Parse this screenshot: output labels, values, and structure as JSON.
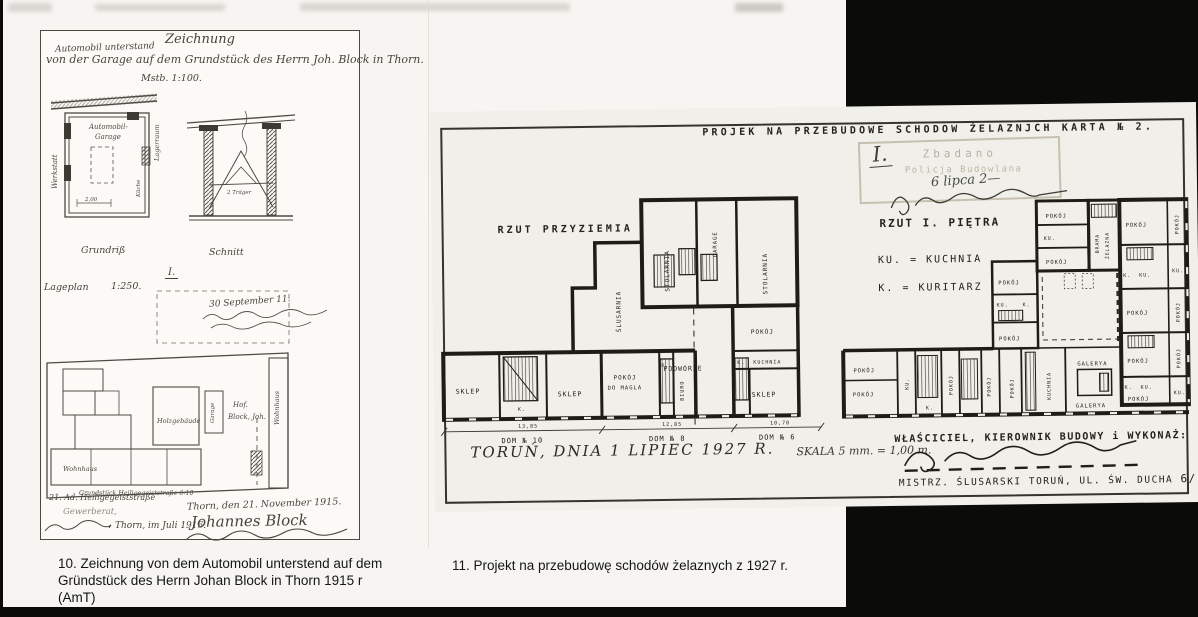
{
  "captions": {
    "c10_l1": "10. Zeichnung von dem Automobil unterstend auf dem",
    "c10_l2": "Gründstück des Herrn Johan Block in Thorn 1915 r (AmT)",
    "c11": "11. Projekt na przebudowę schodów żelaznych z 1927 r."
  },
  "doc10": {
    "title": "Zeichnung",
    "note_small": "Automobil unterstand",
    "subtitle": "von der Garage auf dem Grundstück des Herrn Joh. Block in Thorn.",
    "scale": "Mstb. 1:100.",
    "grundriss": "Grundriß",
    "schnitt": "Schnitt",
    "roman": "I.",
    "lageplan": "Lageplan",
    "lageplan_scale": "1:250.",
    "note_hand": "30 September 11.",
    "werkstatt": "Werkstatt",
    "garage_l1": "Automobil-",
    "garage_l2": "Garage",
    "kueche": "Küche",
    "lagerraum": "Lagerraum",
    "dim_200": "2,00",
    "traeger": "2 Träger",
    "holzgebaeude": "Holzgebäude",
    "garage_site": "Garage",
    "hof_l1": "Hof.",
    "hof_l2": "Block, Joh.",
    "wohnhaus": "Wohnhaus",
    "grundstueck": "Grundstück Heiligegeiststraße 6-10",
    "addr_note": "21. Ad. Heiligegeiststraße",
    "gewerberat": "Gewerberat,",
    "date_left": "Thorn, im Juli 1916.",
    "date_right": "Thorn, den 21. November 1915.",
    "sig": "Johannes Block"
  },
  "doc11": {
    "header": "PROJEK NA PRZEBUDOWE SCHODOW ŻELAZNJCH  KARTA № 2.",
    "stamp": {
      "roman": "I.",
      "l1": "Zbadano",
      "l2": "Policja Budowlana",
      "hand": "6 lipca 2—"
    },
    "ground_title": "RZUT PRZYZIEMIA",
    "first_title": "RZUT I. PIĘTRA",
    "legend_ku": "KU. = KUCHNIA",
    "legend_k": "K.  = KURITARZ",
    "rooms": {
      "pokoj": "POKÓJ",
      "do_magla": "DO MAGLA",
      "ku": "KU.",
      "k": "K.",
      "sklep": "SKLEP",
      "stolarnia": "STOLARNIA",
      "slusarnia": "ŚLUSARNIA",
      "garage": "GARAGE",
      "podworze": "PODWÓRZE",
      "kuchnia": "KUCHNIA",
      "biuro": "BIURO",
      "galerya": "GALERYA",
      "brama1": "BRAMA",
      "brama2": "ŻELAZNA"
    },
    "dims": {
      "d10": "13,85",
      "dom10": "DOM № 10",
      "d8": "12,85",
      "dom8": "DOM № 8",
      "d6": "10,70",
      "dom6": "DOM № 6"
    },
    "date_line": "TORUŃ, DNIA 1 LIPIEC 1927 R.",
    "skala": "SKALA 5 mm. = 1,00 m.",
    "owner_line": "WŁAŚCICIEL, KIEROWNIK BUDOWY i WYKONAŻ:",
    "master_line": "MISTRZ. ŚLUSARSKI  TORUŃ, UL. ŚW. DUCHA",
    "master_no": "6/10"
  }
}
